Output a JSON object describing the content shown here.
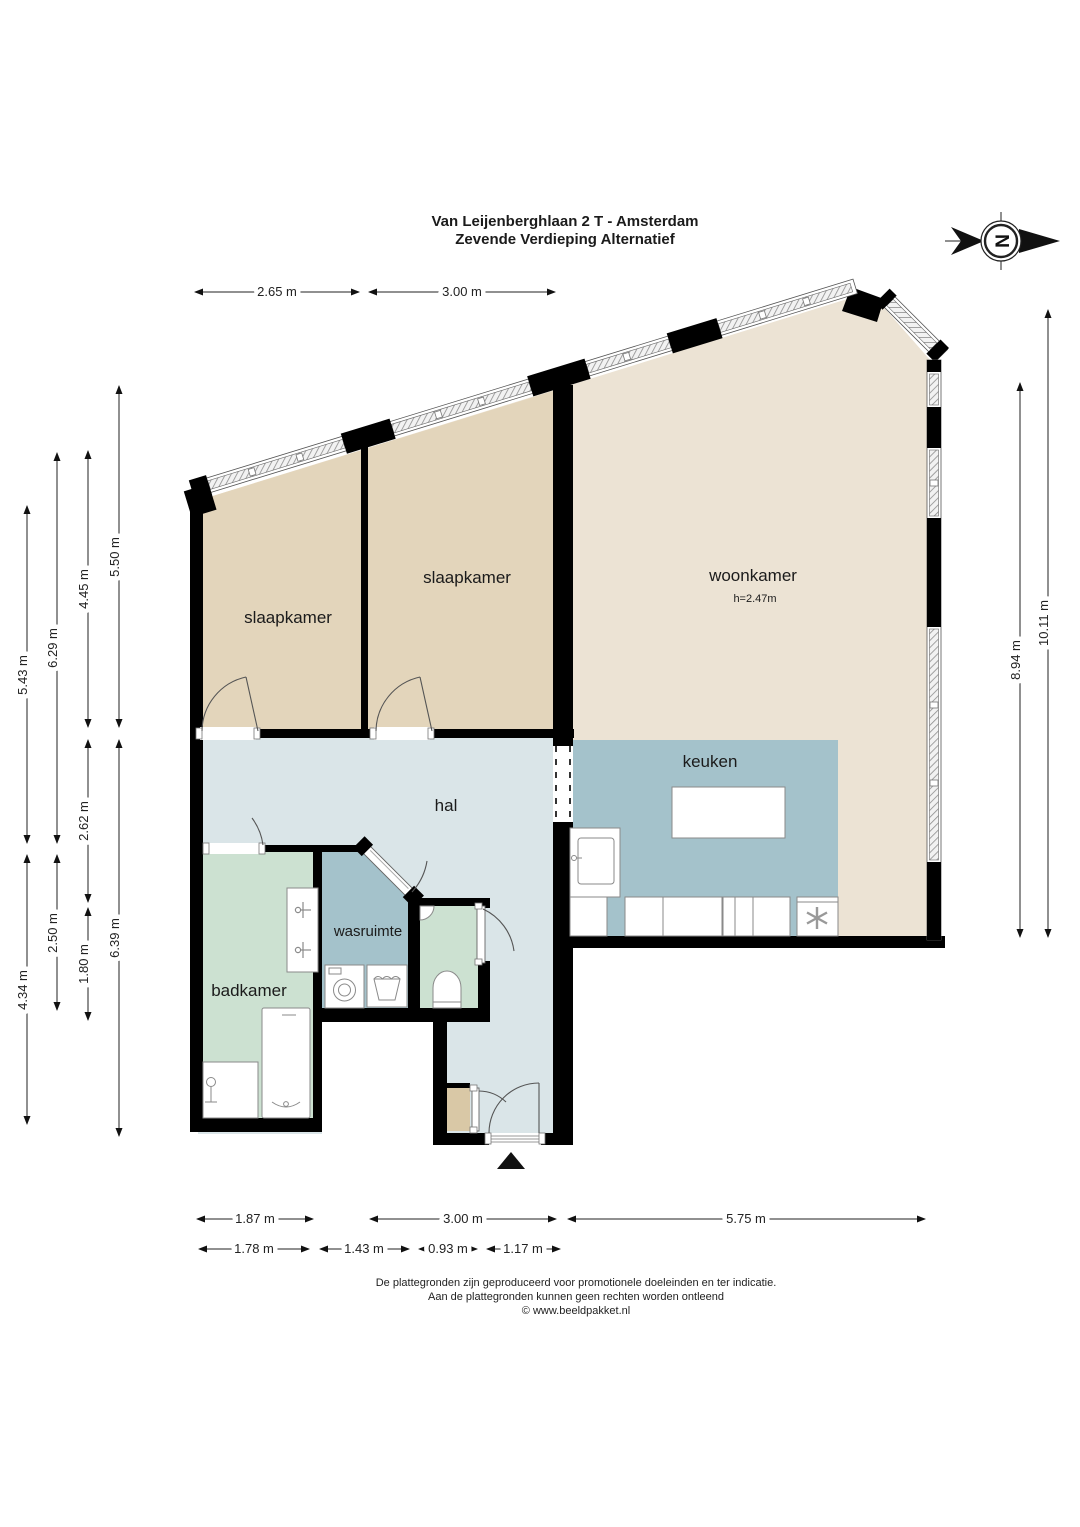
{
  "title": {
    "line1": "Van Leijenberghlaan 2 T - Amsterdam",
    "line2": "Zevende Verdieping Alternatief"
  },
  "north_indicator": {
    "label": "N"
  },
  "rooms": {
    "slaapkamer_left": {
      "label": "slaapkamer"
    },
    "slaapkamer_mid": {
      "label": "slaapkamer"
    },
    "woonkamer": {
      "label": "woonkamer",
      "ceiling_height": "h=2.47m"
    },
    "keuken": {
      "label": "keuken"
    },
    "hal": {
      "label": "hal"
    },
    "wasruimte": {
      "label": "wasruimte"
    },
    "badkamer": {
      "label": "badkamer"
    }
  },
  "dimensions": {
    "top": [
      "2.65 m",
      "3.00 m"
    ],
    "left": [
      "5.50 m",
      "4.45 m",
      "6.29 m",
      "5.43 m",
      "2.62 m",
      "2.50 m",
      "1.80 m",
      "4.34 m",
      "6.39 m"
    ],
    "right": [
      "8.94 m",
      "10.11 m"
    ],
    "bottom": [
      "1.87 m",
      "3.00 m",
      "5.75 m"
    ],
    "bottom2": [
      "1.78 m",
      "1.43 m",
      "0.93 m",
      "1.17 m"
    ]
  },
  "footer": {
    "line1": "De plattegronden zijn geproduceerd voor promotionele doeleinden en ter indicatie.",
    "line2": "Aan de plattegronden kunnen geen rechten worden ontleend",
    "line3": "© www.beeldpakket.nl"
  },
  "colors": {
    "wall": "#000000",
    "bedroom_floor": "#e3d5bb",
    "living_floor": "#ece3d4",
    "kitchen_floor": "#a4c2cb",
    "hall_floor": "#dae5e8",
    "bath_floor": "#cce1d1",
    "toilet_floor": "#cce1d1",
    "laundry_floor": "#a4c2cb",
    "closet_floor": "#d9c8a6"
  }
}
